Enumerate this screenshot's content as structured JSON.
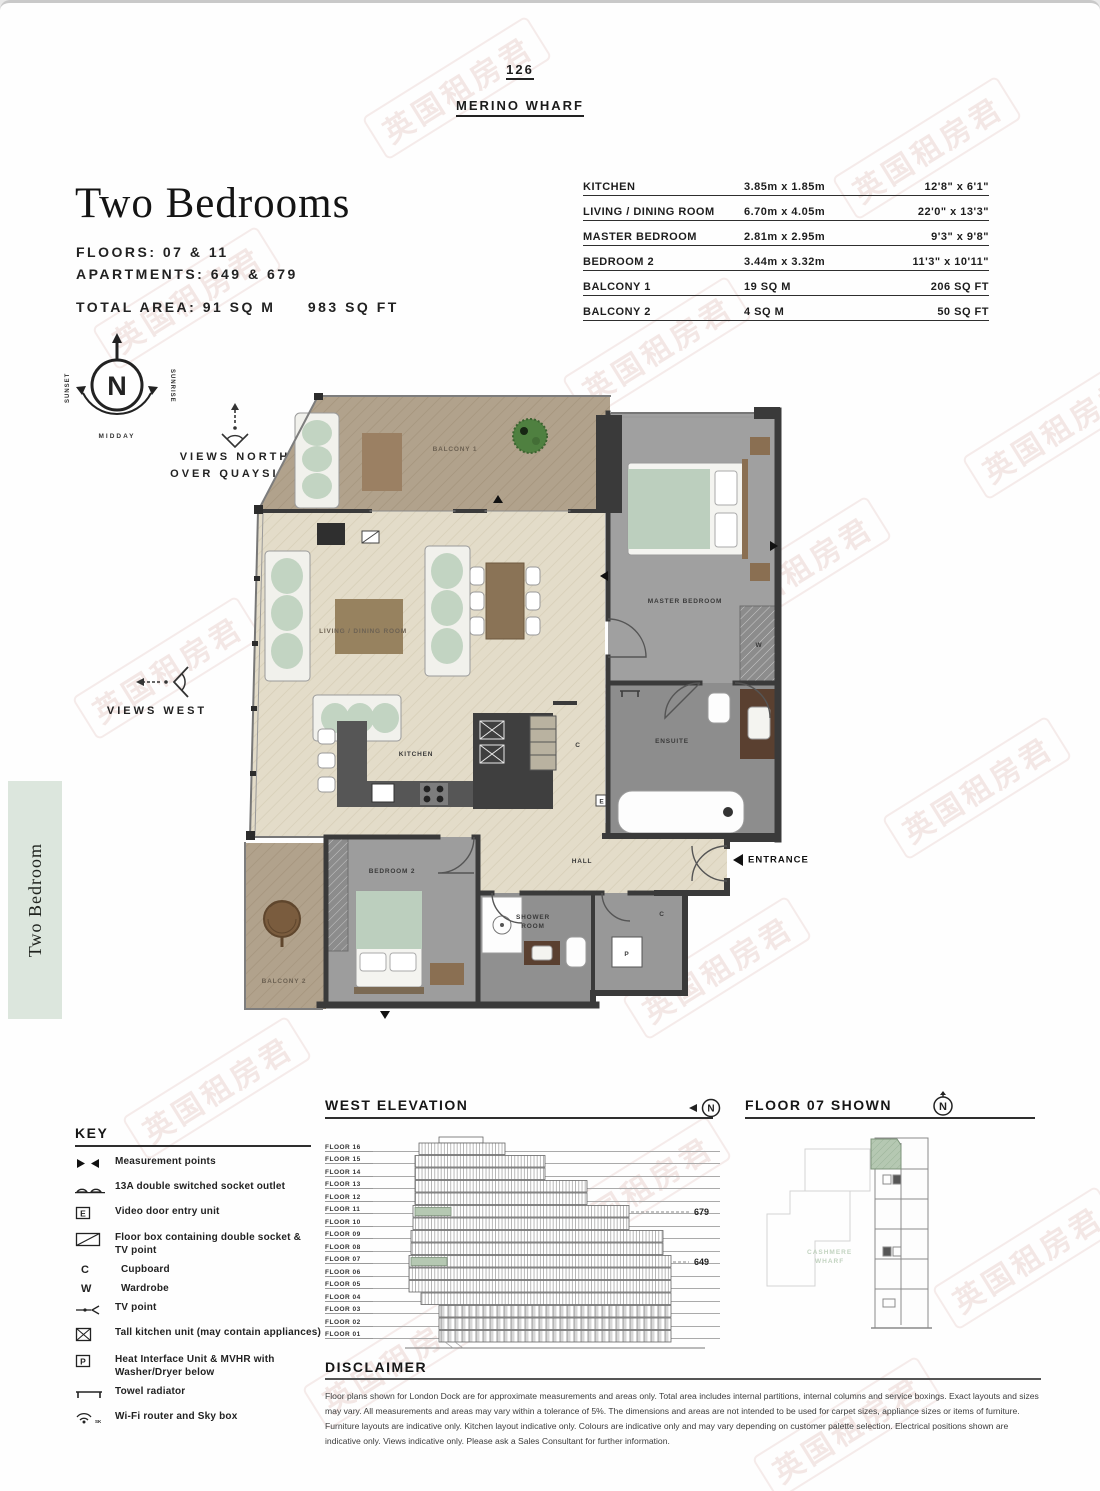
{
  "header": {
    "page_number": "126",
    "project": "MERINO WHARF"
  },
  "unit": {
    "title": "Two Bedrooms",
    "floors_label": "FLOORS: 07 & 11",
    "apartments_label": "APARTMENTS: 649 & 679",
    "total_area_label": "TOTAL AREA: 91 SQ M",
    "total_area_imperial": "983 SQ FT"
  },
  "dimensions_table": {
    "rows": [
      {
        "room": "KITCHEN",
        "metric": "3.85m x 1.85m",
        "imperial": "12'8\" x 6'1\""
      },
      {
        "room": "LIVING / DINING ROOM",
        "metric": "6.70m x 4.05m",
        "imperial": "22'0\" x 13'3\""
      },
      {
        "room": "MASTER BEDROOM",
        "metric": "2.81m x 2.95m",
        "imperial": "9'3\" x 9'8\""
      },
      {
        "room": "BEDROOM 2",
        "metric": "3.44m x 3.32m",
        "imperial": "11'3\" x 10'11\""
      },
      {
        "room": "BALCONY 1",
        "metric": "19 SQ M",
        "imperial": "206 SQ FT"
      },
      {
        "room": "BALCONY 2",
        "metric": "4 SQ M",
        "imperial": "50 SQ FT"
      }
    ]
  },
  "compass": {
    "north": "N",
    "sunset": "SUNSET",
    "sunrise": "SUNRISE",
    "midday": "MIDDAY"
  },
  "views": {
    "north_line1": "VIEWS NORTH",
    "north_line2": "OVER QUAYSIDE",
    "west": "VIEWS WEST"
  },
  "sidebar_tab": {
    "label": "Two Bedroom"
  },
  "floorplan": {
    "rooms": {
      "balcony1": "BALCONY 1",
      "living": "LIVING / DINING ROOM",
      "master": "MASTER BEDROOM",
      "kitchen": "KITCHEN",
      "bedroom2": "BEDROOM 2",
      "balcony2": "BALCONY 2",
      "hall": "HALL",
      "shower_line1": "SHOWER",
      "shower_line2": "ROOM",
      "ensuite": "ENSUITE",
      "entrance": "ENTRANCE"
    },
    "markers": {
      "cupboard": "C",
      "wardrobe": "W",
      "heat_unit": "P",
      "video_entry": "E"
    }
  },
  "key": {
    "title": "KEY",
    "items": [
      {
        "icon": "measurement-points",
        "label": "Measurement points"
      },
      {
        "icon": "double-socket",
        "label": "13A double switched socket outlet"
      },
      {
        "icon": "video-entry",
        "label": "Video door entry unit"
      },
      {
        "icon": "floor-box",
        "label": "Floor box containing double socket & TV point"
      },
      {
        "icon": "letter-c",
        "symbol": "C",
        "label": "Cupboard"
      },
      {
        "icon": "letter-w",
        "symbol": "W",
        "label": "Wardrobe"
      },
      {
        "icon": "tv-point",
        "label": "TV point"
      },
      {
        "icon": "tall-kitchen-unit",
        "label": "Tall kitchen unit (may contain appliances)"
      },
      {
        "icon": "letter-p",
        "symbol": "P",
        "label": "Heat Interface Unit & MVHR with Washer/Dryer below"
      },
      {
        "icon": "towel-radiator",
        "label": "Towel radiator"
      },
      {
        "icon": "wifi",
        "label": "Wi-Fi router and Sky box"
      }
    ]
  },
  "west_elevation": {
    "title": "WEST ELEVATION",
    "floors": [
      "FLOOR 16",
      "FLOOR 15",
      "FLOOR 14",
      "FLOOR 13",
      "FLOOR 12",
      "FLOOR 11",
      "FLOOR 10",
      "FLOOR 09",
      "FLOOR 08",
      "FLOOR 07",
      "FLOOR 06",
      "FLOOR 05",
      "FLOOR 04",
      "FLOOR 03",
      "FLOOR 02",
      "FLOOR 01"
    ],
    "apartment_high": "679",
    "apartment_low": "649",
    "compass": "N"
  },
  "floor_shown": {
    "title": "FLOOR 07 SHOWN",
    "neighbor_line1": "CASHMERE",
    "neighbor_line2": "WHARF",
    "compass": "N"
  },
  "disclaimer": {
    "title": "DISCLAIMER",
    "text": "Floor plans shown for London Dock are for approximate measurements and areas only. Total area includes internal partitions, internal columns and service boxings. Exact layouts and sizes may vary. All measurements and areas may vary within a tolerance of 5%. The dimensions and areas are not intended to be used for carpet sizes, appliance sizes or items of furniture. Furniture layouts are indicative only. Kitchen layout indicative only. Colours are indicative only and may vary depending on customer palette selection. Electrical positions shown are indicative only. Views indicative only. Please ask a Sales Consultant for further information."
  },
  "watermark": {
    "text": "英国租房君"
  },
  "colors": {
    "tab_green": "#dce6dd",
    "plan_beige": "#e3dcc9",
    "plan_brown": "#b1a28c",
    "room_gray": "#9d9d9d",
    "wall": "#3a3a3a",
    "highlight_green": "#b5c8b2",
    "watermark": "#c98b80",
    "wood": "#8a6f52"
  }
}
